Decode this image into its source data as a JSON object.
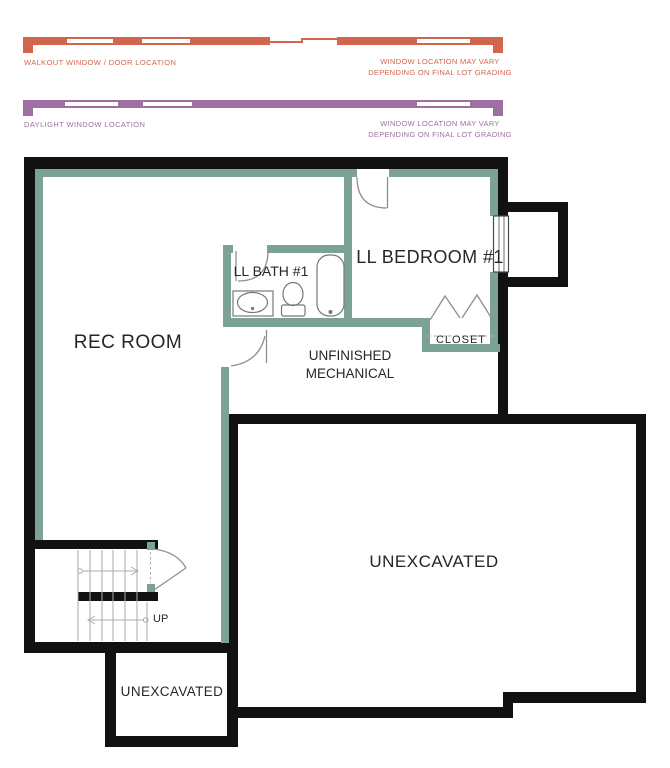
{
  "legend": {
    "walkout": {
      "label": "WALKOUT WINDOW / DOOR LOCATION",
      "note_line1": "WINDOW LOCATION MAY VARY",
      "note_line2": "DEPENDING ON FINAL LOT GRADING",
      "color": "#d2654e"
    },
    "daylight": {
      "label": "DAYLIGHT WINDOW LOCATION",
      "note_line1": "WINDOW LOCATION MAY VARY",
      "note_line2": "DEPENDING ON FINAL LOT GRADING",
      "color": "#9e6fa1"
    }
  },
  "rooms": {
    "rec_room": "REC ROOM",
    "bath": "LL BATH #1",
    "bedroom": "LL BEDROOM #1",
    "mechanical_line1": "UNFINISHED",
    "mechanical_line2": "MECHANICAL",
    "closet": "CLOSET",
    "unexcavated_large": "UNEXCAVATED",
    "unexcavated_small": "UNEXCAVATED",
    "stairs_direction": "UP"
  },
  "theme": {
    "walkout-color": "#d2654e",
    "daylight-color": "#9e6fa1",
    "wall-black": "#111111",
    "wall-green": "#7ba295",
    "line-gray": "#8f8f8f",
    "text-dark": "#262626"
  }
}
